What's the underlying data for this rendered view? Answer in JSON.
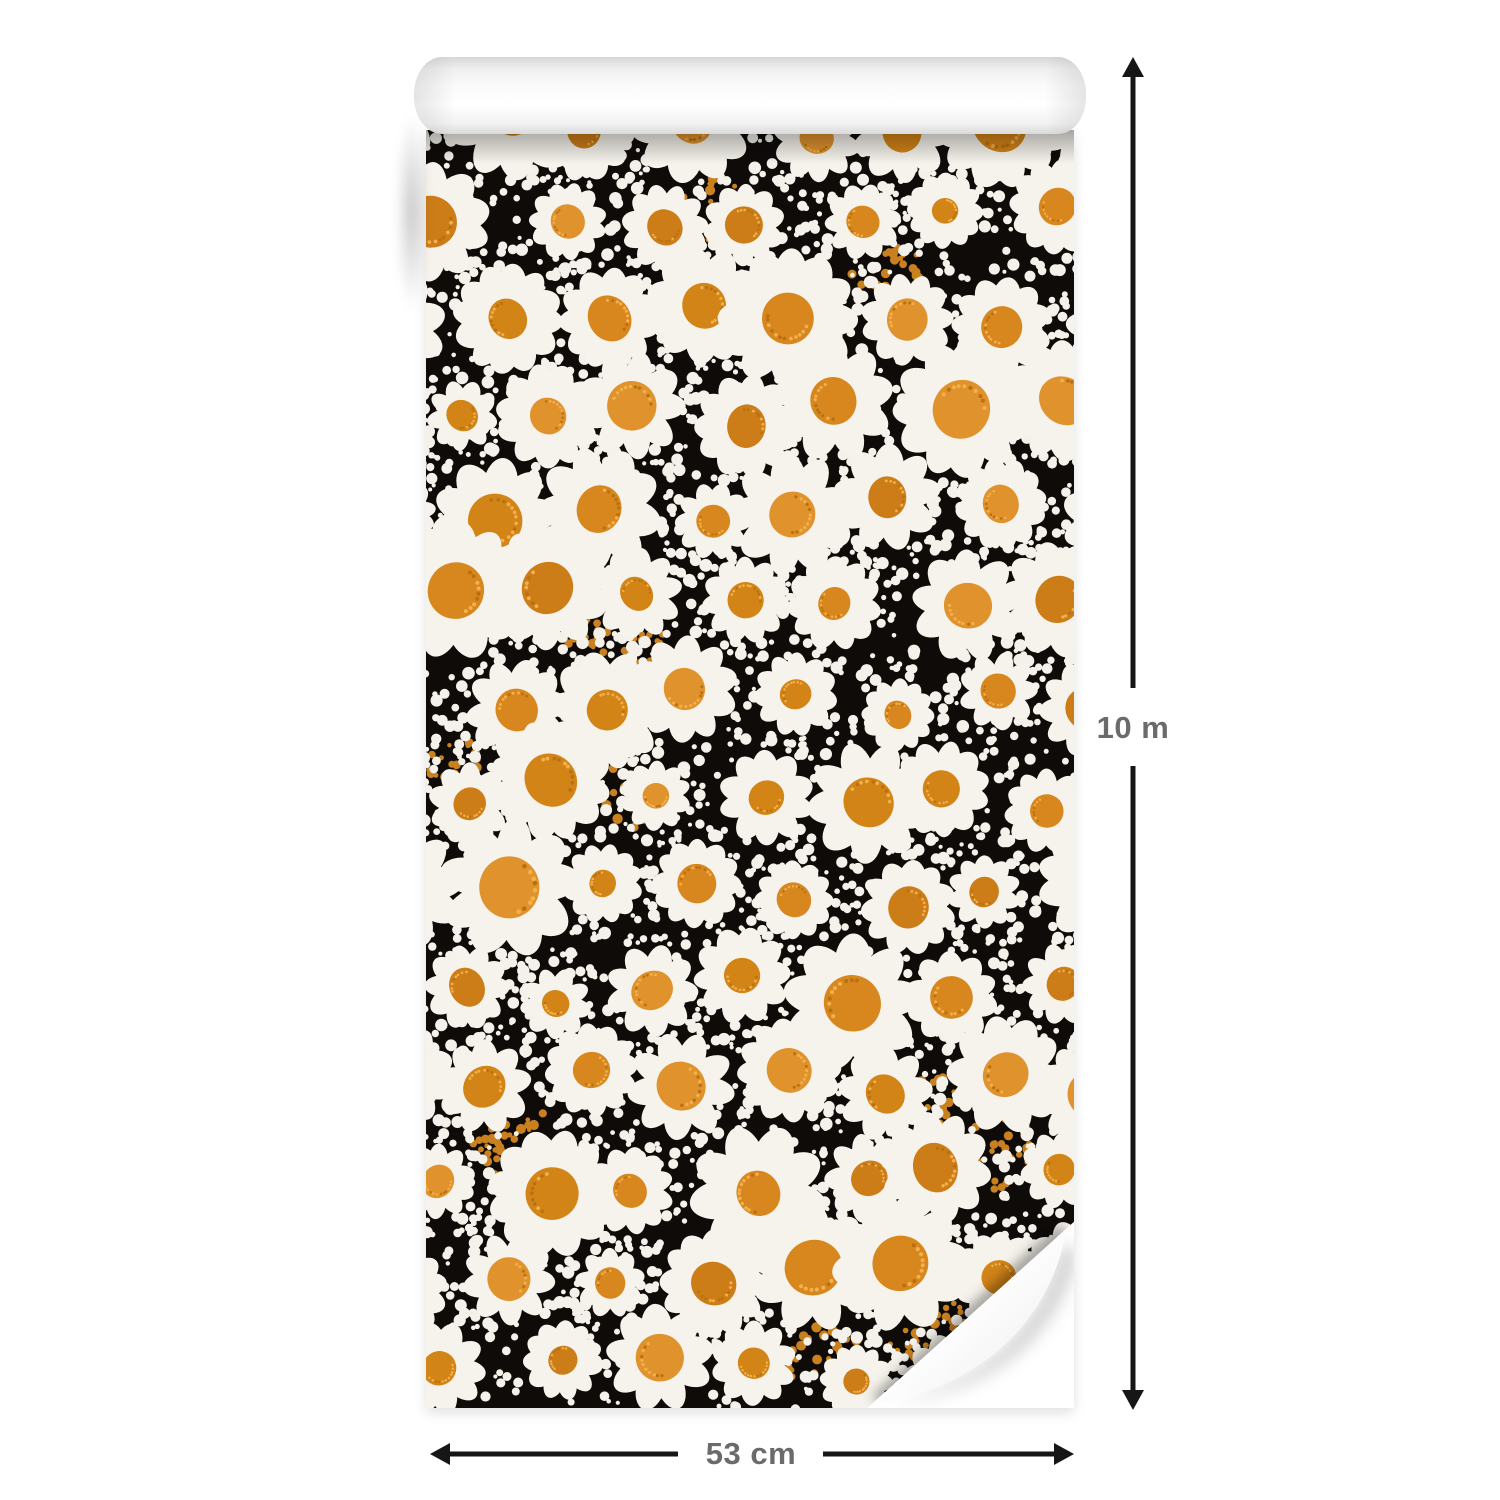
{
  "image": {
    "description": "Roll of wallpaper partially unrolled, with dimension arrows",
    "background_color": "#ffffff"
  },
  "dimensions": {
    "height": {
      "label": "10 m"
    },
    "width": {
      "label": "53 cm"
    },
    "arrow_color": "#161616",
    "label_color": "#6b6b6b"
  },
  "wallpaper": {
    "pattern_name": "white daisies with orange centers on black, dotted background",
    "colors": {
      "background": "#0e0b09",
      "petal": "#f6f3ec",
      "flower_center": [
        "#d8871e",
        "#cc7d18",
        "#e0922d",
        "#d28417"
      ],
      "center_dot_light": "#f2b14e",
      "center_dot_dark": "#b9700f",
      "white_dot": "#f4f1ea",
      "orange_dot": "#c9811f"
    },
    "roll_color": "#ffffff"
  }
}
